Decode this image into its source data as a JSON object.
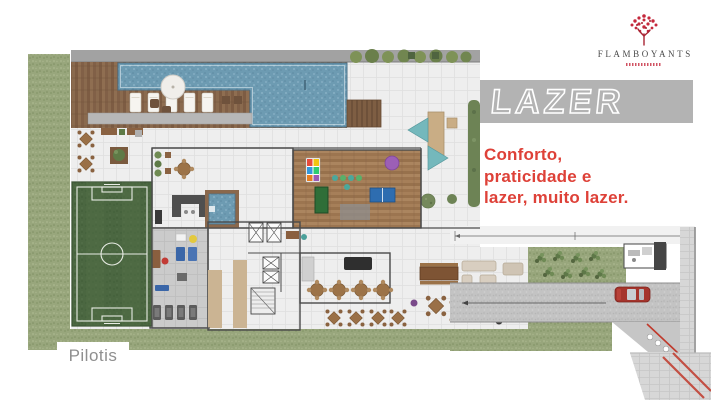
{
  "slide": {
    "background": "#ffffff"
  },
  "logo": {
    "name": "FLAMBOYANTS",
    "icon": "flamboyant-tree",
    "icon_color": "#c5283c",
    "name_color": "#4a4a4a"
  },
  "banner": {
    "title": "LAZER",
    "background": "#b3b3b3",
    "text_outline_color": "#ffffff"
  },
  "tagline": {
    "color": "#de4138",
    "lines": [
      "Conforto,",
      "praticidade e",
      "lazer, muito lazer."
    ]
  },
  "plan": {
    "caption": "Pilotis",
    "caption_color": "#8f8f8f",
    "accent_colors": {
      "grass": "#98a67c",
      "pool_water": "#6d9bb2",
      "wood_deck": "#85644a",
      "soccer_field": "#4b6741",
      "paving": "#eeeeee",
      "driveway": "#c3c3c3",
      "car": "#a5342c"
    }
  }
}
